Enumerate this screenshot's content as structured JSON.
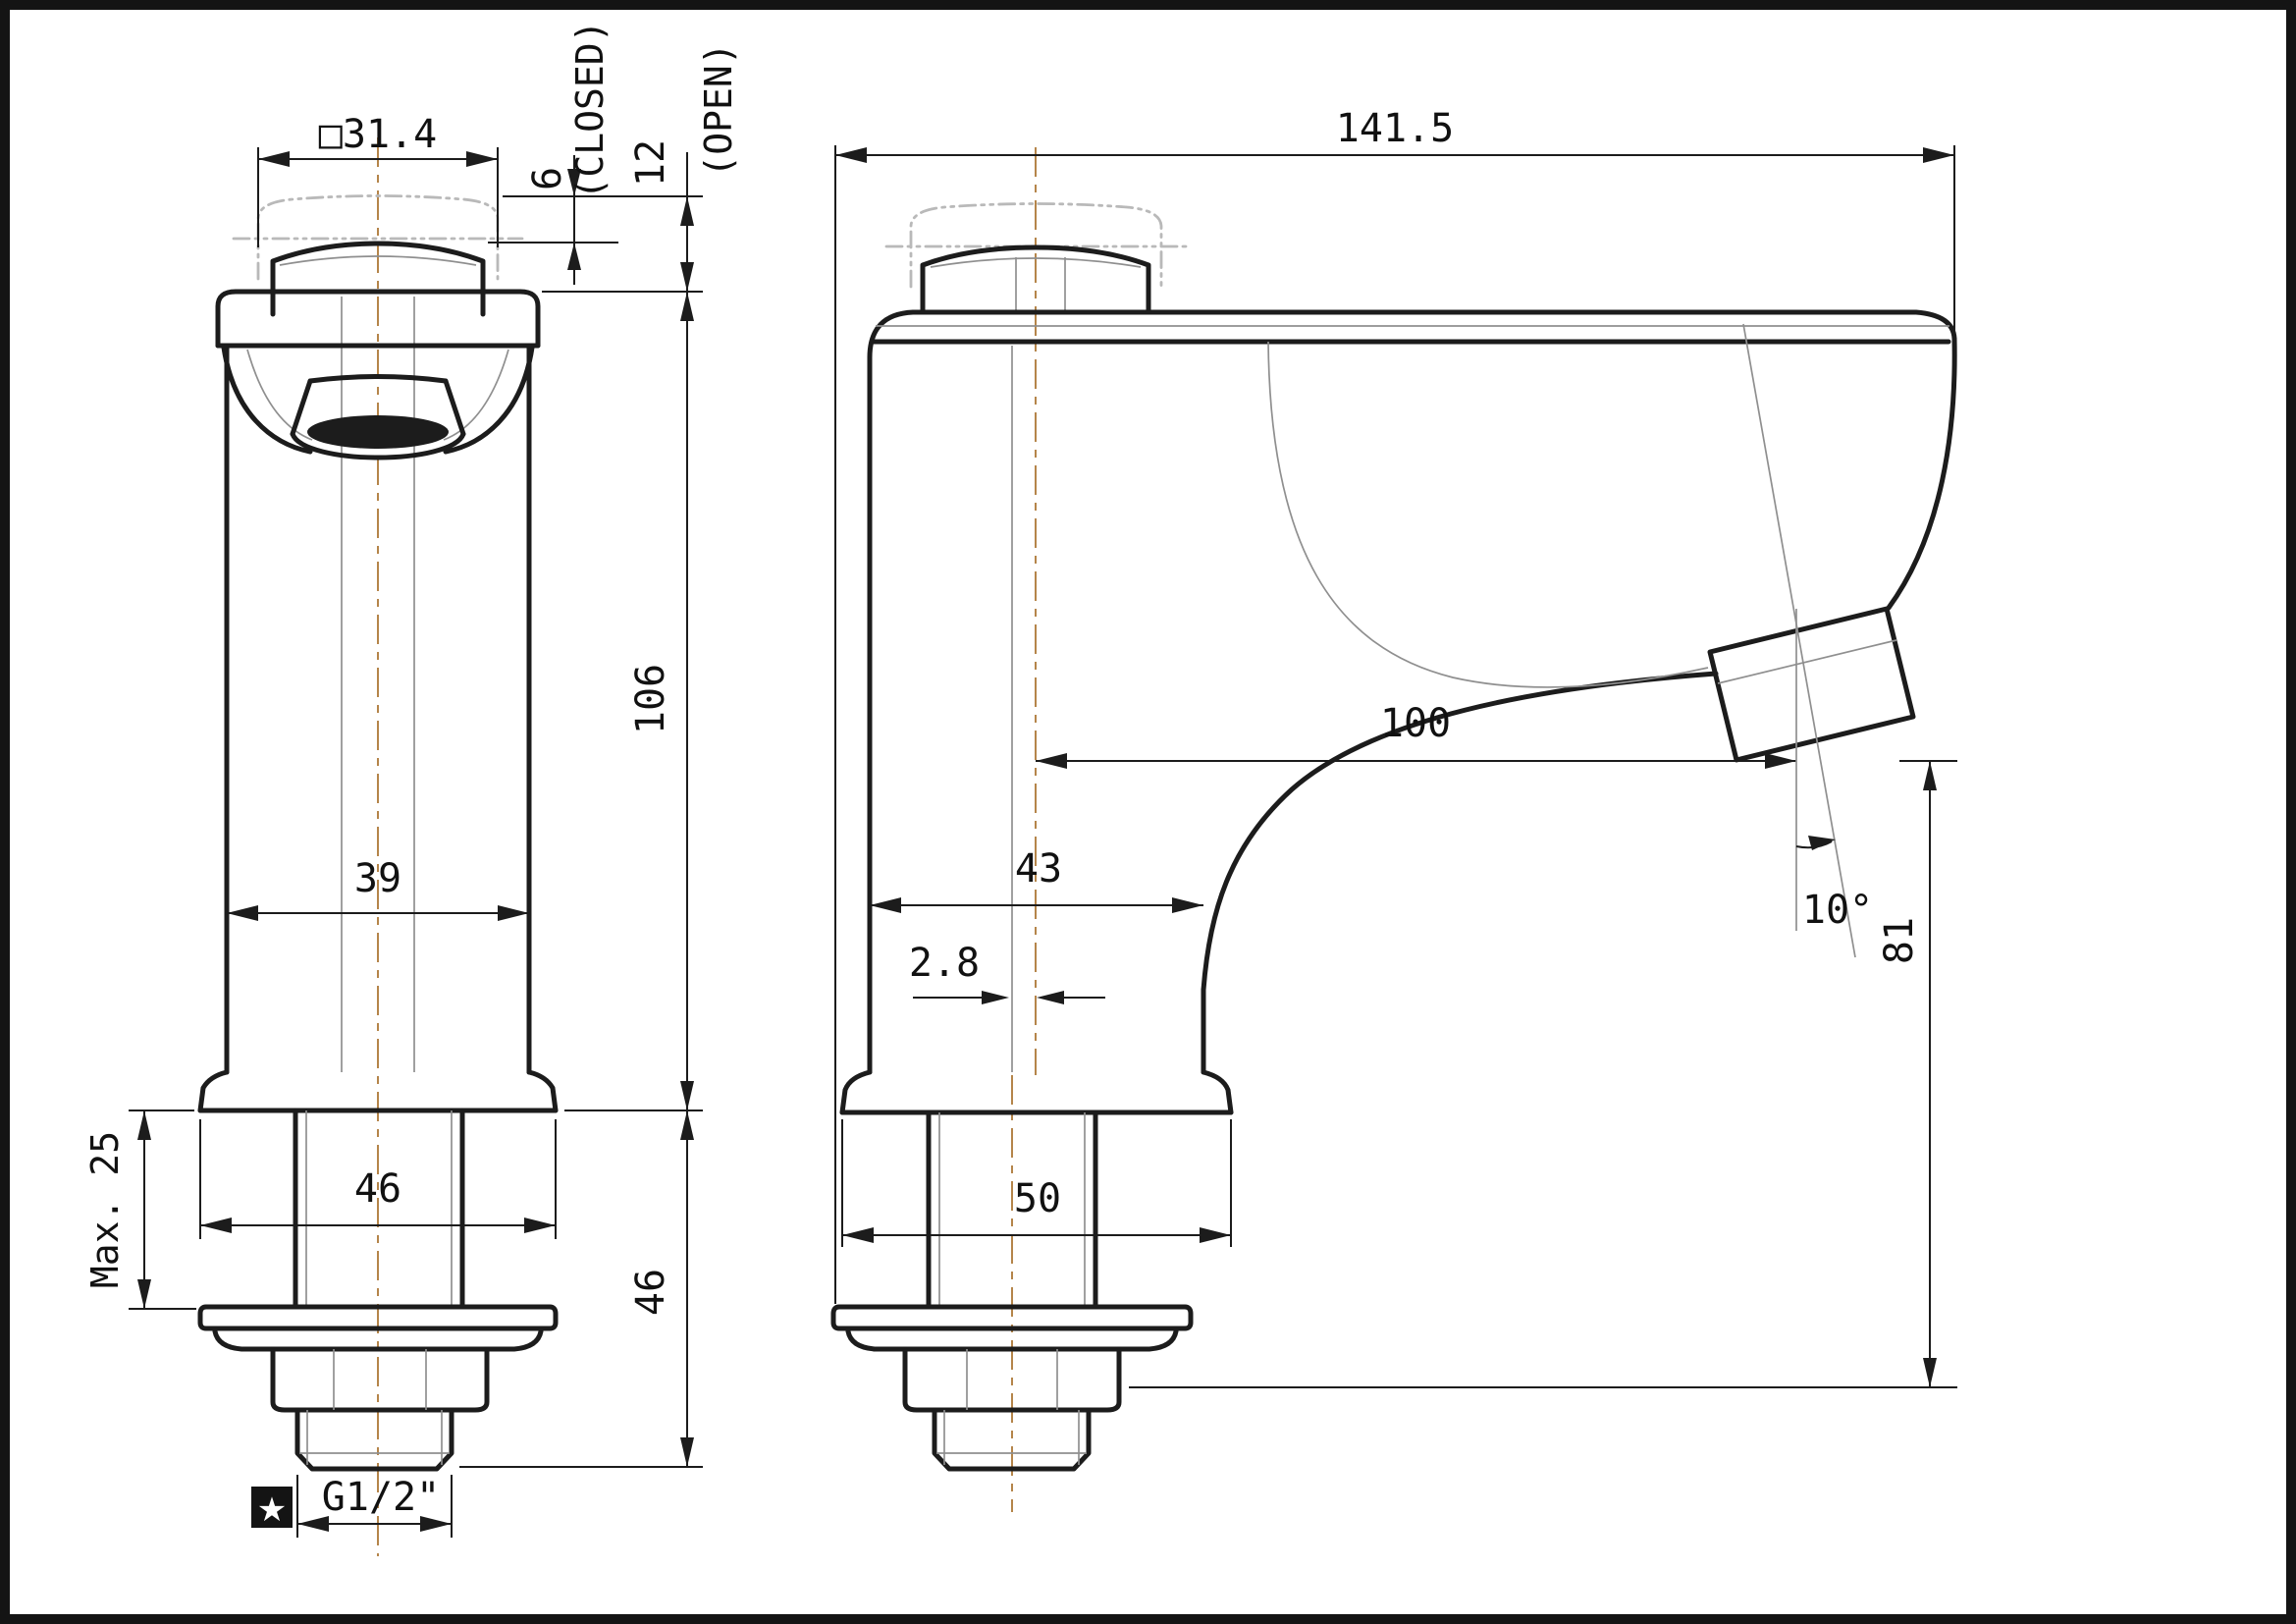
{
  "drawing": {
    "kind": "technical dimension drawing",
    "subject": "pillar tap faucet, two orthographic views",
    "front_view": {
      "name": "front view",
      "dims": {
        "button_width": "□31.4",
        "closed_offset": "6",
        "closed_label": "(CLOSED)",
        "open_offset": "12",
        "open_label": "(OPEN)",
        "body_height": "106",
        "body_width": "39",
        "max_mount_thickness": "Max. 25",
        "base_width": "46",
        "shank_length": "46",
        "thread_spec": "G1/2\""
      },
      "symbols": {
        "star": "★"
      }
    },
    "side_view": {
      "name": "side view",
      "dims": {
        "overall_length": "141.5",
        "spout_reach": "100",
        "outlet_angle": "10°",
        "outlet_height": "81",
        "body_depth": "43",
        "center_offset": "2.8",
        "base_depth": "50"
      }
    },
    "colors": {
      "line": "#1c1c1c",
      "thin_line": "#8f8f8f",
      "phantom_line": "#b9b9b9",
      "centerline": "#b5854a",
      "background": "#ffffff",
      "frame": "#141414"
    }
  }
}
